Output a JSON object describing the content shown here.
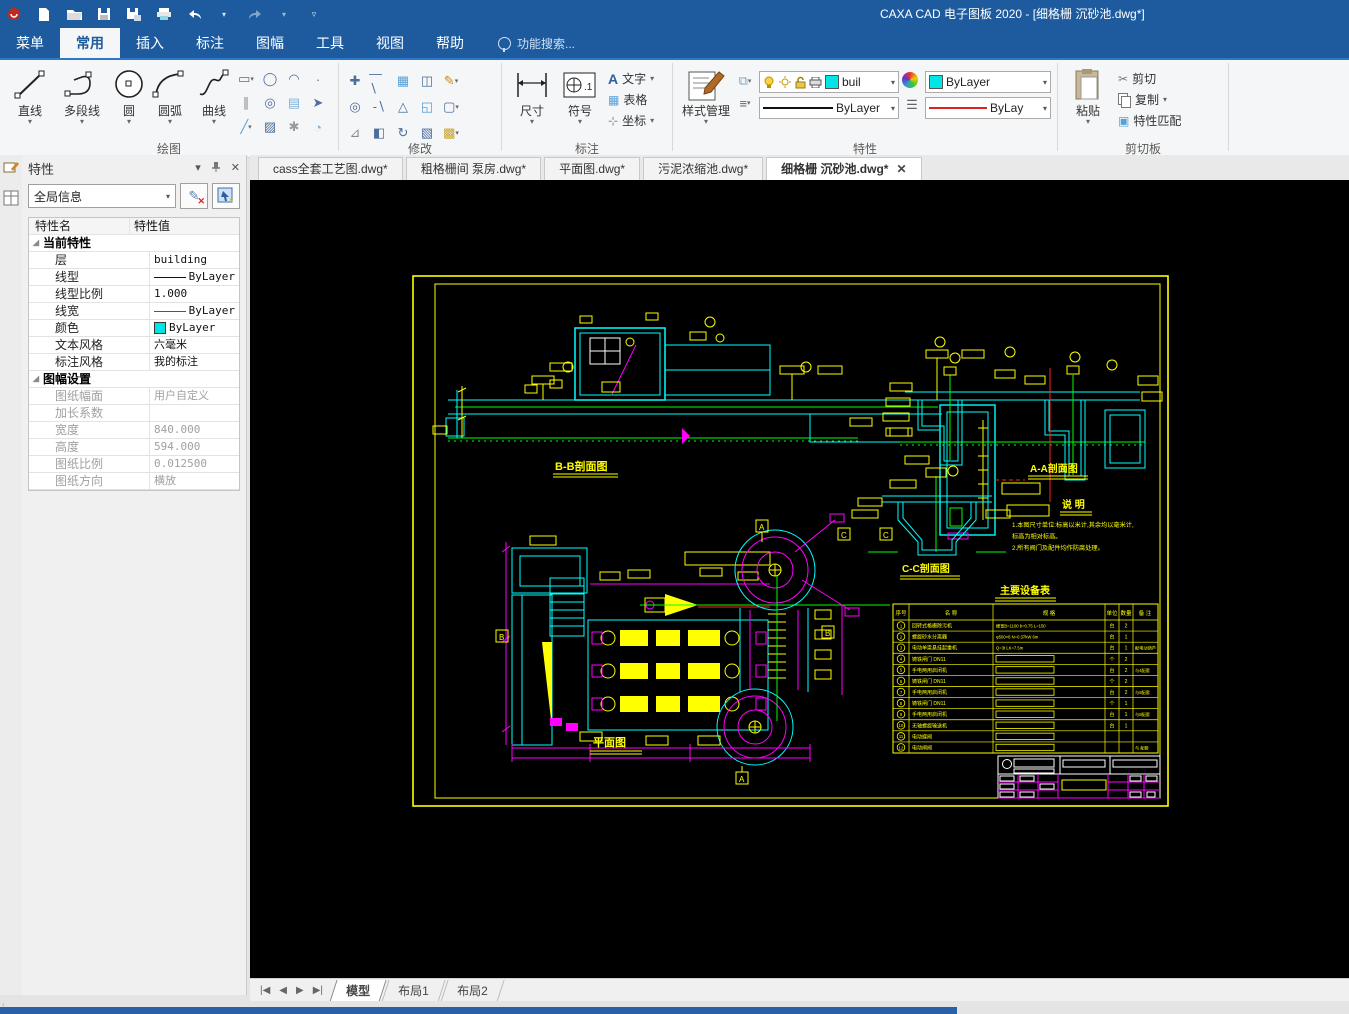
{
  "title_bar": {
    "title": "CAXA CAD 电子图板 2020 - [细格栅 沉砂池.dwg*]"
  },
  "menu_tabs": [
    {
      "label": "菜单",
      "active": false
    },
    {
      "label": "常用",
      "active": true
    },
    {
      "label": "插入",
      "active": false
    },
    {
      "label": "标注",
      "active": false
    },
    {
      "label": "图幅",
      "active": false
    },
    {
      "label": "工具",
      "active": false
    },
    {
      "label": "视图",
      "active": false
    },
    {
      "label": "帮助",
      "active": false
    }
  ],
  "search": {
    "label": "功能搜索..."
  },
  "ribbon": {
    "draw": {
      "label": "绘图",
      "buttons": [
        "直线",
        "多段线",
        "圆",
        "圆弧",
        "曲线"
      ]
    },
    "modify": {
      "label": "修改"
    },
    "annotate": {
      "label": "标注",
      "dim": "尺寸",
      "symbol": "符号",
      "text": "文字",
      "table": "表格",
      "coord": "坐标"
    },
    "props": {
      "label": "特性",
      "style_manager": "样式管理",
      "layer_value": "buil",
      "color_value": "ByLayer",
      "linetype_value": "ByLayer",
      "linewidth_value": "ByLay"
    },
    "clipboard": {
      "label": "剪切板",
      "paste": "粘贴",
      "cut": "剪切",
      "copy": "复制",
      "match": "特性匹配"
    }
  },
  "doc_tabs": [
    {
      "label": "cass全套工艺图.dwg*",
      "active": false
    },
    {
      "label": "粗格栅间 泵房.dwg*",
      "active": false
    },
    {
      "label": "平面图.dwg*",
      "active": false
    },
    {
      "label": "污泥浓缩池.dwg*",
      "active": false
    },
    {
      "label": "细格栅 沉砂池.dwg*",
      "active": true
    }
  ],
  "properties_panel": {
    "title": "特性",
    "selector": "全局信息",
    "col_name": "特性名",
    "col_value": "特性值",
    "groups": [
      {
        "label": "当前特性",
        "dim": false,
        "rows": [
          {
            "name": "层",
            "value": "building",
            "swatch": "none"
          },
          {
            "name": "线型",
            "value": "ByLayer",
            "swatch": "line"
          },
          {
            "name": "线型比例",
            "value": "1.000",
            "swatch": "none"
          },
          {
            "name": "线宽",
            "value": "ByLayer",
            "swatch": "thinline"
          },
          {
            "name": "颜色",
            "value": "ByLayer",
            "swatch": "cyan"
          },
          {
            "name": "文本风格",
            "value": "六毫米",
            "swatch": "none"
          },
          {
            "name": "标注风格",
            "value": "我的标注",
            "swatch": "none"
          }
        ]
      },
      {
        "label": "图幅设置",
        "dim": true,
        "rows": [
          {
            "name": "图纸幅面",
            "value": "用户自定义",
            "swatch": "none"
          },
          {
            "name": "加长系数",
            "value": "",
            "swatch": "none"
          },
          {
            "name": "宽度",
            "value": "840.000",
            "swatch": "none"
          },
          {
            "name": "高度",
            "value": "594.000",
            "swatch": "none"
          },
          {
            "name": "图纸比例",
            "value": "0.012500",
            "swatch": "none"
          },
          {
            "name": "图纸方向",
            "value": "横放",
            "swatch": "none"
          }
        ]
      }
    ]
  },
  "drawing": {
    "labels": {
      "bb": "B-B剖面图",
      "aa": "A-A剖面图",
      "cc": "C-C剖面图",
      "plan": "平面图",
      "notes_title": "说 明",
      "table_title": "主要设备表"
    },
    "notes": [
      "1.本图尺寸单位:标高以米计,其余均以毫米计,",
      "  标高为相对标高。",
      "2.所有阀门及配件均作防腐处理。"
    ],
    "equipment_table": {
      "headers": [
        "序号",
        "名 称",
        "规 格",
        "单位",
        "数量",
        "备 注"
      ],
      "rows": [
        {
          "no": "1",
          "name": "回转式格栅除污机",
          "spec": "栅宽B=1100 b=0.75 L=150",
          "unit": "台",
          "qty": "2",
          "remark": ""
        },
        {
          "no": "2",
          "name": "螺旋砂水分离器",
          "spec": "φ500×8 N=0.37kW 6m",
          "unit": "台",
          "qty": "1",
          "remark": ""
        },
        {
          "no": "3",
          "name": "电动单梁悬挂起重机",
          "spec": "Q=3t LK=7.5m",
          "unit": "台",
          "qty": "1",
          "remark": "配电动葫芦"
        },
        {
          "no": "4",
          "name": "铸铁闸门 DN11",
          "spec": "",
          "unit": "个",
          "qty": "2",
          "remark": ""
        },
        {
          "no": "5",
          "name": "手电两用启闭机",
          "spec": "",
          "unit": "台",
          "qty": "2",
          "remark": "与4配套"
        },
        {
          "no": "6",
          "name": "铸铁闸门 DN11",
          "spec": "",
          "unit": "个",
          "qty": "2",
          "remark": ""
        },
        {
          "no": "7",
          "name": "手电两用启闭机",
          "spec": "",
          "unit": "台",
          "qty": "2",
          "remark": "与6配套"
        },
        {
          "no": "8",
          "name": "铸铁闸门 DN11",
          "spec": "",
          "unit": "个",
          "qty": "1",
          "remark": ""
        },
        {
          "no": "9",
          "name": "手电两用启闭机",
          "spec": "",
          "unit": "台",
          "qty": "1",
          "remark": "与8配套"
        },
        {
          "no": "10",
          "name": "无轴螺旋输送机",
          "spec": "",
          "unit": "台",
          "qty": "1",
          "remark": ""
        },
        {
          "no": "11",
          "name": "电动蝶阀",
          "spec": "",
          "unit": "",
          "qty": "",
          "remark": ""
        },
        {
          "no": "12",
          "name": "电动闸阀",
          "spec": "",
          "unit": "",
          "qty": "",
          "remark": "与 配套"
        }
      ]
    }
  },
  "model_tabs": [
    {
      "label": "模型",
      "active": true
    },
    {
      "label": "布局1",
      "active": false
    },
    {
      "label": "布局2",
      "active": false
    }
  ],
  "colors": {
    "titlebar": "#1e5b9e",
    "cad_yellow": "#ffff00",
    "cad_cyan": "#00ffff",
    "cad_magenta": "#ff00ff",
    "cad_green": "#00ff00"
  }
}
